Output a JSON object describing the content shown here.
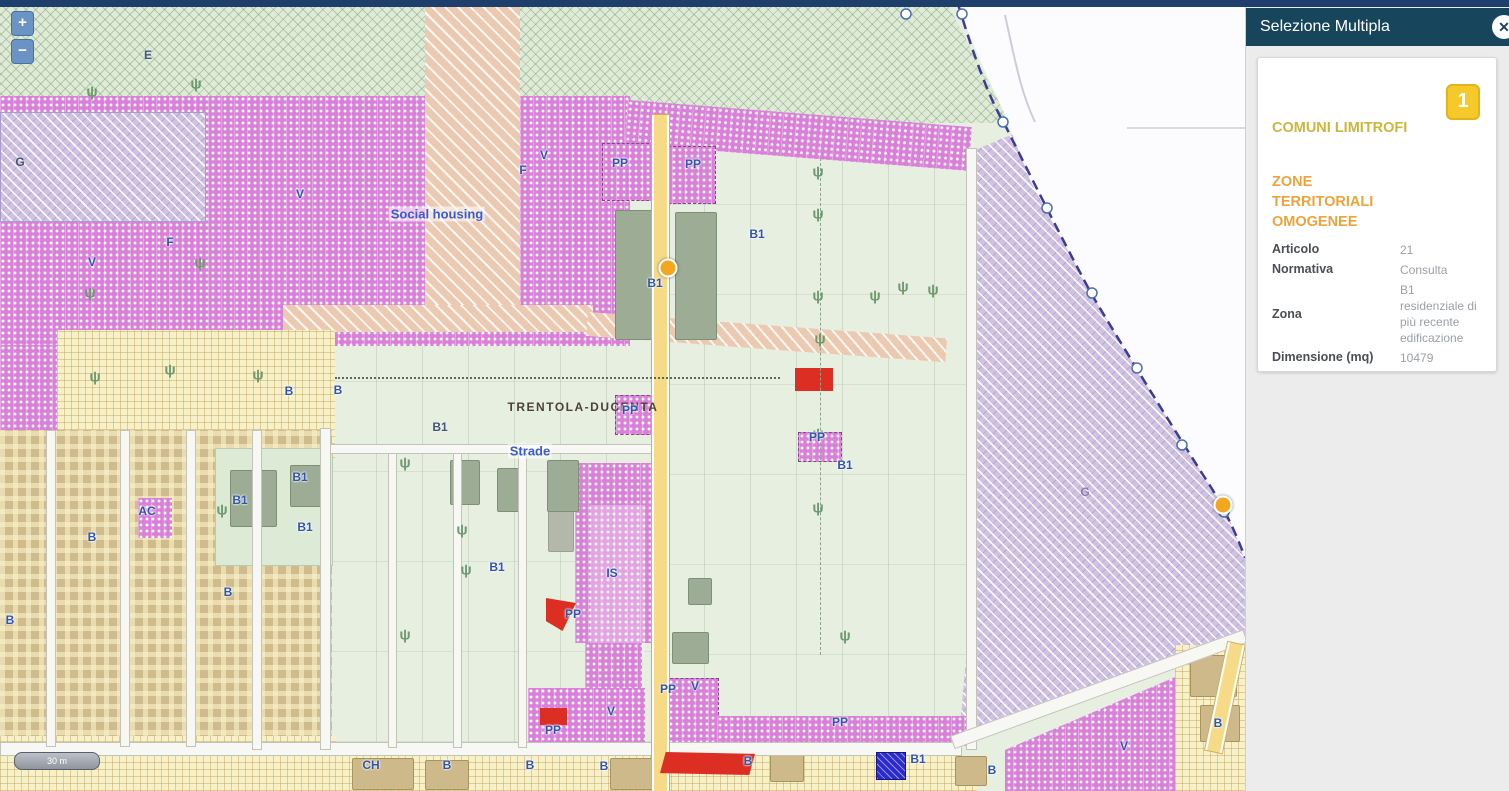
{
  "panel": {
    "title": "Selezione Multipla",
    "close_icon": "✕",
    "badge": "1",
    "section1_title": "COMUNI LIMITROFI",
    "section2_title": "ZONE TERRITORIALI OMOGENEE",
    "fields": [
      {
        "label": "Articolo",
        "value": "21"
      },
      {
        "label": "Normativa",
        "value": "Consulta"
      },
      {
        "label": "Zona",
        "value": "B1 residenziale di più recente edificazione"
      },
      {
        "label": "Dimensione (mq)",
        "value": "10479"
      }
    ]
  },
  "map": {
    "zoom_in": "+",
    "zoom_out": "−",
    "scale_label": "30 m",
    "labels": [
      {
        "t": "E",
        "x": 148,
        "y": 55,
        "c": "dark"
      },
      {
        "t": "G",
        "x": 20,
        "y": 162,
        "c": "dark"
      },
      {
        "t": "G",
        "x": 1085,
        "y": 492,
        "c": "faint"
      },
      {
        "t": "V",
        "x": 92,
        "y": 262,
        "c": "blue"
      },
      {
        "t": "F",
        "x": 170,
        "y": 242,
        "c": "blue"
      },
      {
        "t": "V",
        "x": 300,
        "y": 194,
        "c": "blue"
      },
      {
        "t": "F",
        "x": 523,
        "y": 170,
        "c": "blue"
      },
      {
        "t": "V",
        "x": 544,
        "y": 155,
        "c": "blue"
      },
      {
        "t": "Social housing",
        "x": 437,
        "y": 214,
        "c": "place"
      },
      {
        "t": "B",
        "x": 289,
        "y": 391,
        "c": "blue"
      },
      {
        "t": "B",
        "x": 338,
        "y": 390,
        "c": "blue"
      },
      {
        "t": "PP",
        "x": 620,
        "y": 163,
        "c": "blue"
      },
      {
        "t": "PP",
        "x": 693,
        "y": 164,
        "c": "blue"
      },
      {
        "t": "B1",
        "x": 655,
        "y": 283,
        "c": "blue"
      },
      {
        "t": "B1",
        "x": 757,
        "y": 234,
        "c": "blue"
      },
      {
        "t": "TRENTOLA-DUCENTA",
        "x": 583,
        "y": 407,
        "c": "city"
      },
      {
        "t": "B1",
        "x": 440,
        "y": 427,
        "c": "dark"
      },
      {
        "t": "Strade",
        "x": 530,
        "y": 451,
        "c": "place"
      },
      {
        "t": "PP",
        "x": 630,
        "y": 410,
        "c": "blue"
      },
      {
        "t": "PP",
        "x": 817,
        "y": 437,
        "c": "blue"
      },
      {
        "t": "B1",
        "x": 845,
        "y": 465,
        "c": "blue"
      },
      {
        "t": "B1",
        "x": 300,
        "y": 477,
        "c": "blue"
      },
      {
        "t": "B1",
        "x": 240,
        "y": 500,
        "c": "blue"
      },
      {
        "t": "B1",
        "x": 305,
        "y": 527,
        "c": "blue"
      },
      {
        "t": "B1",
        "x": 497,
        "y": 567,
        "c": "blue"
      },
      {
        "t": "AC",
        "x": 147,
        "y": 511,
        "c": "blue"
      },
      {
        "t": "B",
        "x": 92,
        "y": 537,
        "c": "blue"
      },
      {
        "t": "B",
        "x": 228,
        "y": 592,
        "c": "blue"
      },
      {
        "t": "B",
        "x": 10,
        "y": 620,
        "c": "blue"
      },
      {
        "t": "IS",
        "x": 612,
        "y": 573,
        "c": "blue"
      },
      {
        "t": "PP",
        "x": 573,
        "y": 614,
        "c": "blue"
      },
      {
        "t": "PP",
        "x": 668,
        "y": 689,
        "c": "blue"
      },
      {
        "t": "V",
        "x": 695,
        "y": 686,
        "c": "blue"
      },
      {
        "t": "V",
        "x": 611,
        "y": 711,
        "c": "blue"
      },
      {
        "t": "PP",
        "x": 553,
        "y": 730,
        "c": "blue"
      },
      {
        "t": "PP",
        "x": 840,
        "y": 722,
        "c": "blue"
      },
      {
        "t": "CH",
        "x": 371,
        "y": 765,
        "c": "blue"
      },
      {
        "t": "B",
        "x": 447,
        "y": 765,
        "c": "blue"
      },
      {
        "t": "B",
        "x": 530,
        "y": 765,
        "c": "blue"
      },
      {
        "t": "B",
        "x": 604,
        "y": 766,
        "c": "blue"
      },
      {
        "t": "B",
        "x": 748,
        "y": 761,
        "c": "blue"
      },
      {
        "t": "B1",
        "x": 918,
        "y": 759,
        "c": "blue"
      },
      {
        "t": "B",
        "x": 992,
        "y": 770,
        "c": "blue"
      },
      {
        "t": "B",
        "x": 1218,
        "y": 723,
        "c": "blue"
      },
      {
        "t": "V",
        "x": 1124,
        "y": 746,
        "c": "blue"
      }
    ],
    "trees": [
      {
        "x": 92,
        "y": 92
      },
      {
        "x": 196,
        "y": 84
      },
      {
        "x": 90,
        "y": 293
      },
      {
        "x": 200,
        "y": 263
      },
      {
        "x": 95,
        "y": 377
      },
      {
        "x": 170,
        "y": 370
      },
      {
        "x": 258,
        "y": 375
      },
      {
        "x": 405,
        "y": 463
      },
      {
        "x": 222,
        "y": 510
      },
      {
        "x": 462,
        "y": 530
      },
      {
        "x": 466,
        "y": 570
      },
      {
        "x": 405,
        "y": 635
      },
      {
        "x": 818,
        "y": 172
      },
      {
        "x": 818,
        "y": 214
      },
      {
        "x": 818,
        "y": 296
      },
      {
        "x": 820,
        "y": 339
      },
      {
        "x": 818,
        "y": 434
      },
      {
        "x": 818,
        "y": 508
      },
      {
        "x": 845,
        "y": 636
      },
      {
        "x": 875,
        "y": 296
      },
      {
        "x": 903,
        "y": 287
      },
      {
        "x": 933,
        "y": 290
      }
    ],
    "markers": [
      {
        "x": 668,
        "y": 268
      },
      {
        "x": 1223,
        "y": 505
      }
    ]
  },
  "colors": {
    "topbar": "#1e3f6c",
    "panel_header": "#17465c",
    "badge": "#f5c929",
    "section1": "#cdb53e",
    "section2": "#eda33c",
    "zone_magenta": "#d981d9",
    "zone_purple": "#cfc2e3",
    "zone_green": "#dfead7",
    "zone_urban": "#d0bb8d",
    "marker": "#f2a71f",
    "highlight_red": "#dd2e23",
    "boundary_blue": "#3c3c96"
  }
}
